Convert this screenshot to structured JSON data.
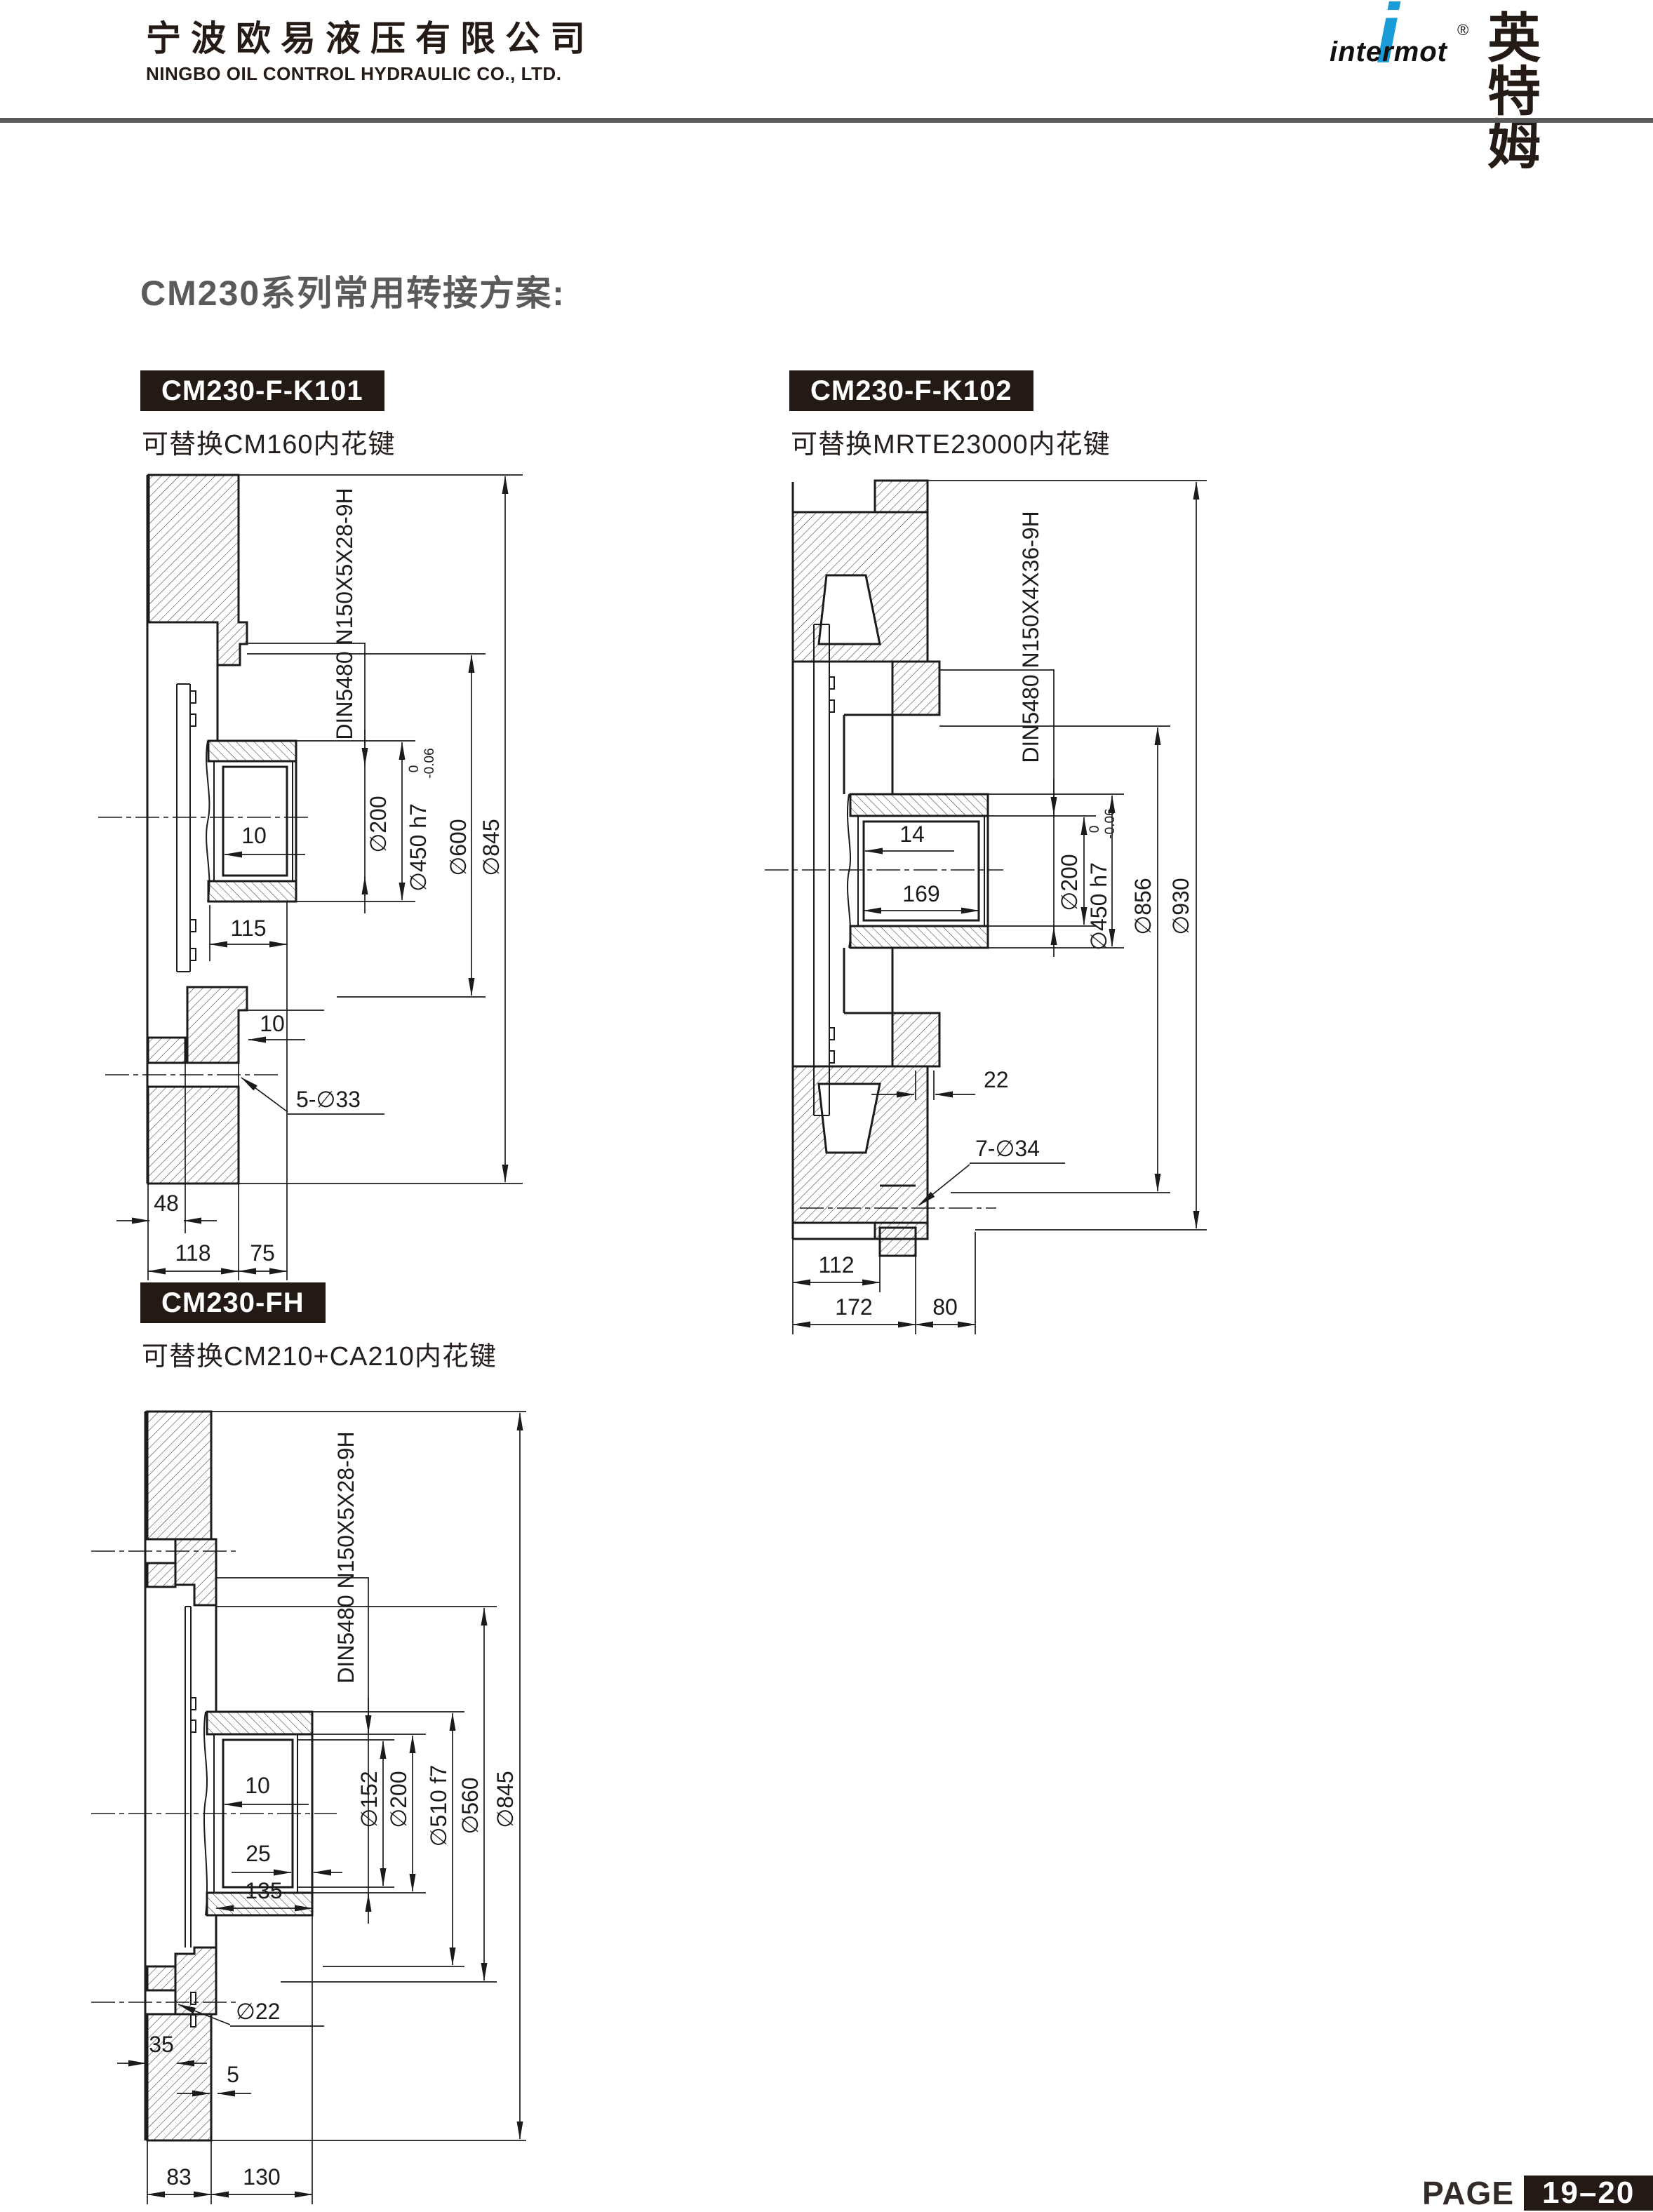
{
  "header": {
    "company_name_cn": "宁波欧易液压有限公司",
    "company_name_en": "NINGBO OIL CONTROL HYDRAULIC CO., LTD.",
    "logo": {
      "i_glyph": "i",
      "brand": "intermot",
      "brand_cn": "英特姆",
      "registered_mark": "®"
    }
  },
  "page_title": "CM230系列常用转接方案:",
  "sections": [
    {
      "label": "CM230-F-K101",
      "subtitle": "可替换CM160内花键"
    },
    {
      "label": "CM230-F-K102",
      "subtitle": "可替换MRTE23000内花键"
    },
    {
      "label": "CM230-FH",
      "subtitle": "可替换CM210+CA210内花键"
    }
  ],
  "drawings": {
    "k101": {
      "spline_spec": "DIN5480 N150X5X28-9H",
      "dia_200": "∅200",
      "dia_450": "∅450 h7",
      "tol_upper": "0",
      "tol_lower": "-0.06",
      "dia_600": "∅600",
      "dia_845": "∅845",
      "dim_bore_step": "10",
      "dim_hub_len": "115",
      "dim_step": "10",
      "bolt_holes": "5-∅33",
      "dim_48": "48",
      "dim_118": "118",
      "dim_75": "75"
    },
    "k102": {
      "spline_spec": "DIN5480 N150X4X36-9H",
      "dia_200": "∅200",
      "dia_450": "∅450 h7",
      "tol_upper": "0",
      "tol_lower": "-0.06",
      "dia_856": "∅856",
      "dia_930": "∅930",
      "dim_14": "14",
      "dim_169": "169",
      "dim_22": "22",
      "bolt_holes": "7-∅34",
      "dim_112": "112",
      "dim_172": "172",
      "dim_80": "80"
    },
    "fh": {
      "spline_spec": "DIN5480 N150X5X28-9H",
      "dia_152": "∅152",
      "dia_200": "∅200",
      "dia_510": "∅510 f7",
      "dia_560": "∅560",
      "dia_845": "∅845",
      "dim_bore_step": "10",
      "dim_25": "25",
      "dim_135": "135",
      "dim_35": "35",
      "dim_5": "5",
      "bolt_hole": "∅22",
      "dim_83": "83",
      "dim_130": "130"
    }
  },
  "footer": {
    "page_label": "PAGE",
    "page_number": "19–20"
  }
}
